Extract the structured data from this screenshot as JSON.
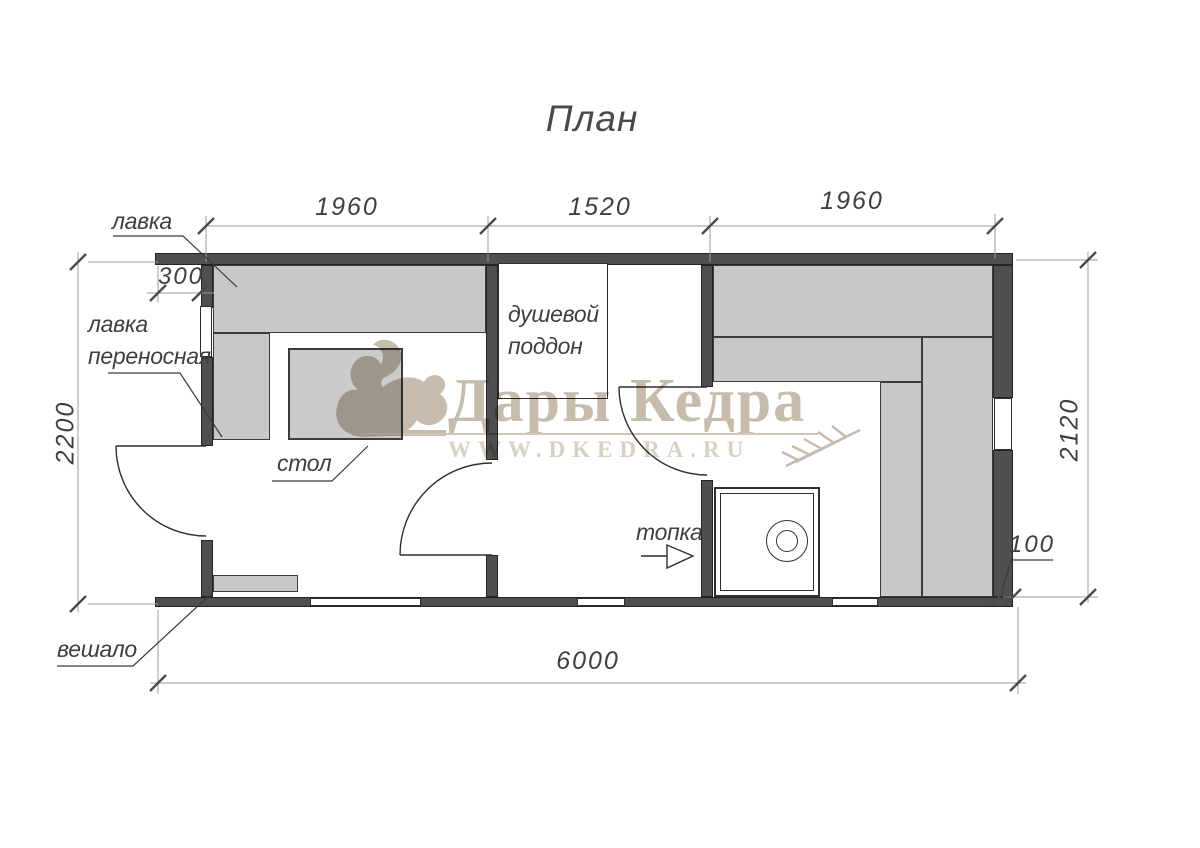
{
  "title": "План",
  "dimensions": {
    "top_left": "1960",
    "top_middle": "1520",
    "top_right": "1960",
    "porch": "300",
    "left": "2200",
    "right": "2120",
    "wall": "100",
    "bottom": "6000"
  },
  "labels": {
    "bench": "лавка",
    "bench_portable_line1": "лавка",
    "bench_portable_line2": "переносная",
    "shower_line1": "душевой",
    "shower_line2": "поддон",
    "table": "стол",
    "firebox": "топка",
    "hanger": "вешало"
  },
  "watermark": {
    "brand": "Дары Кедра",
    "site": "WWW.DKEDRA.RU"
  },
  "colors": {
    "wall": "#4f4f4f",
    "bench": "#c8c8c8",
    "bench_border": "#3c3c3c",
    "line": "#2f2f2f",
    "dim_line": "#9b9b9b",
    "tick": "#4a4a4a",
    "text": "#3f3f3f",
    "watermark_text": "#c6bcab",
    "watermark_site": "#d8d0c2",
    "watermark_logo": "#c6bcae"
  }
}
